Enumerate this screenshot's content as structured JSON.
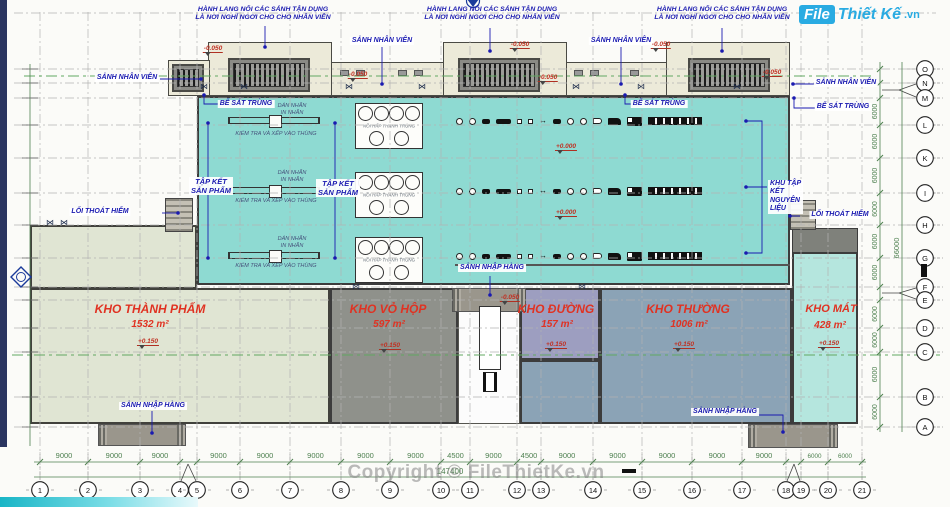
{
  "logo": {
    "part1": "File",
    "part2": "Thiết Kế",
    "part3": ".vn"
  },
  "watermark": "Copyright © FileThietKe.vn",
  "title_note": {
    "line1": "HÀNH LANG NỐI CÁC SẢNH TẬN DỤNG",
    "line2": "LÀ NƠI NGHỈ NGƠI CHO CHO NHÂN VIÊN"
  },
  "labels": {
    "sanh_nhan_vien": "SẢNH NHÂN VIÊN",
    "be_sat_trung": "BỂ SÁT TRÙNG",
    "tap_ket_line1": "TẬP KẾT",
    "tap_ket_line2": "SẢN PHẨM",
    "khu_tap_ket": [
      "KHU TẬP",
      "KẾT",
      "NGUYÊN",
      "LIỆU"
    ],
    "loi_thoat_hiem": "LỐI THOÁT HIỂM",
    "sanh_nhap_hang": "SẢNH NHẬP HÀNG",
    "dan_nhan_line1": "DÁN NHÃN",
    "dan_nhan_line2": "IN NHÃN",
    "kiem_tra": "KIỂM TRA VÀ XẾP VÀO THÙNG",
    "noi_hap": "NỒI HẤP THANH TRÙNG"
  },
  "rooms": [
    {
      "name": "KHO THÀNH PHẨM",
      "area": "1532 m²",
      "elevation": "+0.150"
    },
    {
      "name": "KHO VỎ HỘP",
      "area": "597 m²",
      "elevation": "+0.150"
    },
    {
      "name": "KHO ĐƯỜNG",
      "area": "157 m²",
      "elevation": "+0.150"
    },
    {
      "name": "KHO THƯỜNG",
      "area": "1006 m²",
      "elevation": "+0.150"
    },
    {
      "name": "KHO MÁT",
      "area": "428 m²",
      "elevation": "+0.150"
    }
  ],
  "elevations": {
    "zero": "+0.000",
    "minus_050": "-0.050",
    "plus_150": "+0.150"
  },
  "grid": {
    "columns": [
      "1",
      "2",
      "3",
      "4",
      "5",
      "6",
      "7",
      "8",
      "9",
      "10",
      "11",
      "12",
      "13",
      "14",
      "15",
      "16",
      "17",
      "18",
      "19",
      "20",
      "21"
    ],
    "rows": [
      "O",
      "N",
      "M",
      "L",
      "K",
      "I",
      "H",
      "G",
      "F",
      "E",
      "D",
      "C",
      "B",
      "A"
    ],
    "bottom_dims": [
      "9000",
      "9000",
      "9000",
      "9000",
      "9000",
      "9000",
      "9000",
      "9000",
      "4500",
      "9000",
      "4500",
      "9000",
      "9000",
      "9000",
      "9000",
      "9000",
      "6000",
      "6000"
    ],
    "bottom_total": "147400",
    "side_dim": "6000",
    "side_total": "66000"
  },
  "icons": {
    "door_swing": "⋈",
    "arrows": "↔"
  },
  "colors": {
    "hall_teal": "#8edad2",
    "mint": "#b5e6de",
    "steel": "#8ba3b6",
    "purple": "#9d9ec0",
    "warm_gray": "#8f918b",
    "sage": "#e0e5d3",
    "cream": "#ecead9",
    "dim_green": "#4e8050",
    "annotation_blue": "#1a1ab0",
    "room_red": "#e03222",
    "logo_blue": "#29abe2"
  }
}
